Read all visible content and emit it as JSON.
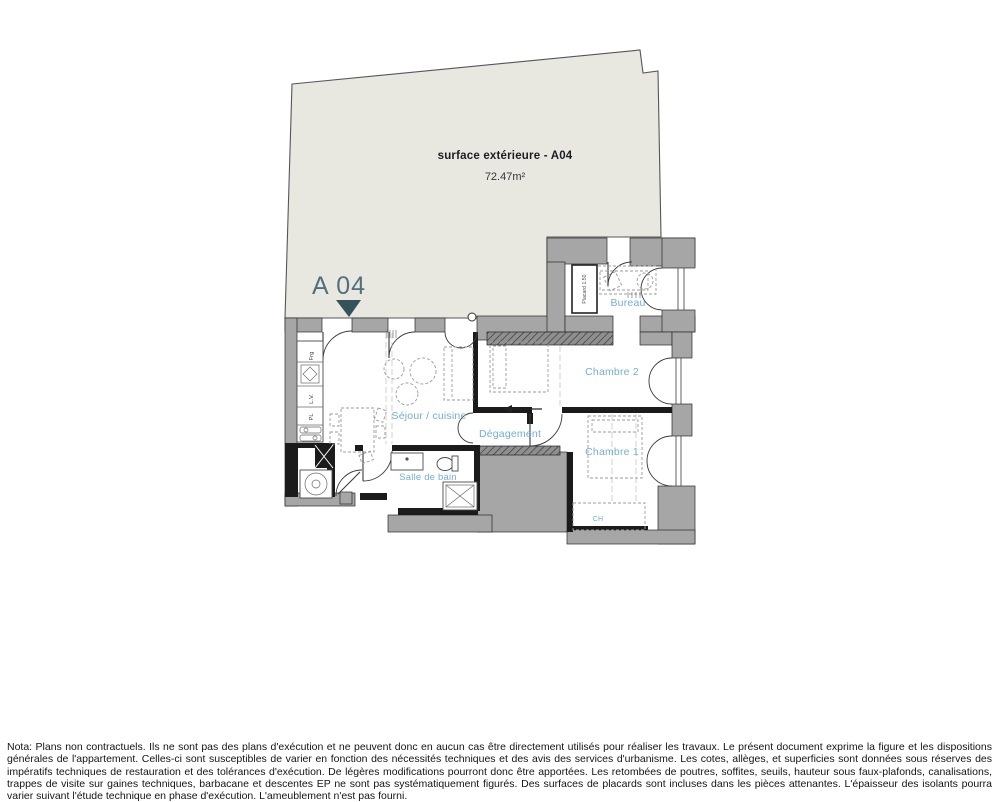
{
  "unit": {
    "label": "A 04"
  },
  "terrace": {
    "label": "surface extérieure - A04",
    "area": "72.47m²"
  },
  "rooms": {
    "sejour": "Séjour / cuisine",
    "degagement": "Dégagement",
    "chambre1": "Chambre 1",
    "chambre2": "Chambre 2",
    "bureau": "Bureau",
    "salle_de_bain": "Salle de bain",
    "placard": "Placard 1.50",
    "ch": "CH"
  },
  "appliances": {
    "fridge": "Frg",
    "dishwasher": "L.V.",
    "cupboard": "PL"
  },
  "colors": {
    "terrace_fill": "#e9e8e0",
    "wall_gray": "#a6a6a6",
    "partition_black": "#1b1b1b",
    "room_label_blue": "#72aed3",
    "unit_label": "#50707e",
    "marker": "#33525a"
  },
  "note": "Nota: Plans non contractuels. Ils ne sont pas des plans d'exécution et ne peuvent donc en aucun cas être directement utilisés pour réaliser les travaux. Le présent document exprime la figure et les dispositions générales de l'appartement. Celles-ci sont susceptibles de varier en fonction des nécessités techniques et des avis des services d'urbanisme. Les cotes, allèges, et superficies sont données sous réserves des impératifs techniques de restauration et des tolérances d'exécution. De légères modifications pourront donc être apportées. Les retombées de poutres, soffites, seuils,  hauteur sous faux-plafonds, canalisations, trappes de visite sur gaines techniques, barbacane et descentes EP ne sont pas systématiquement figurés. Des surfaces de placards sont incluses dans les pièces attenantes. L'épaisseur des isolants pourra varier suivant l'étude technique en phase d'exécution. L'ameublement n'est pas fourni."
}
